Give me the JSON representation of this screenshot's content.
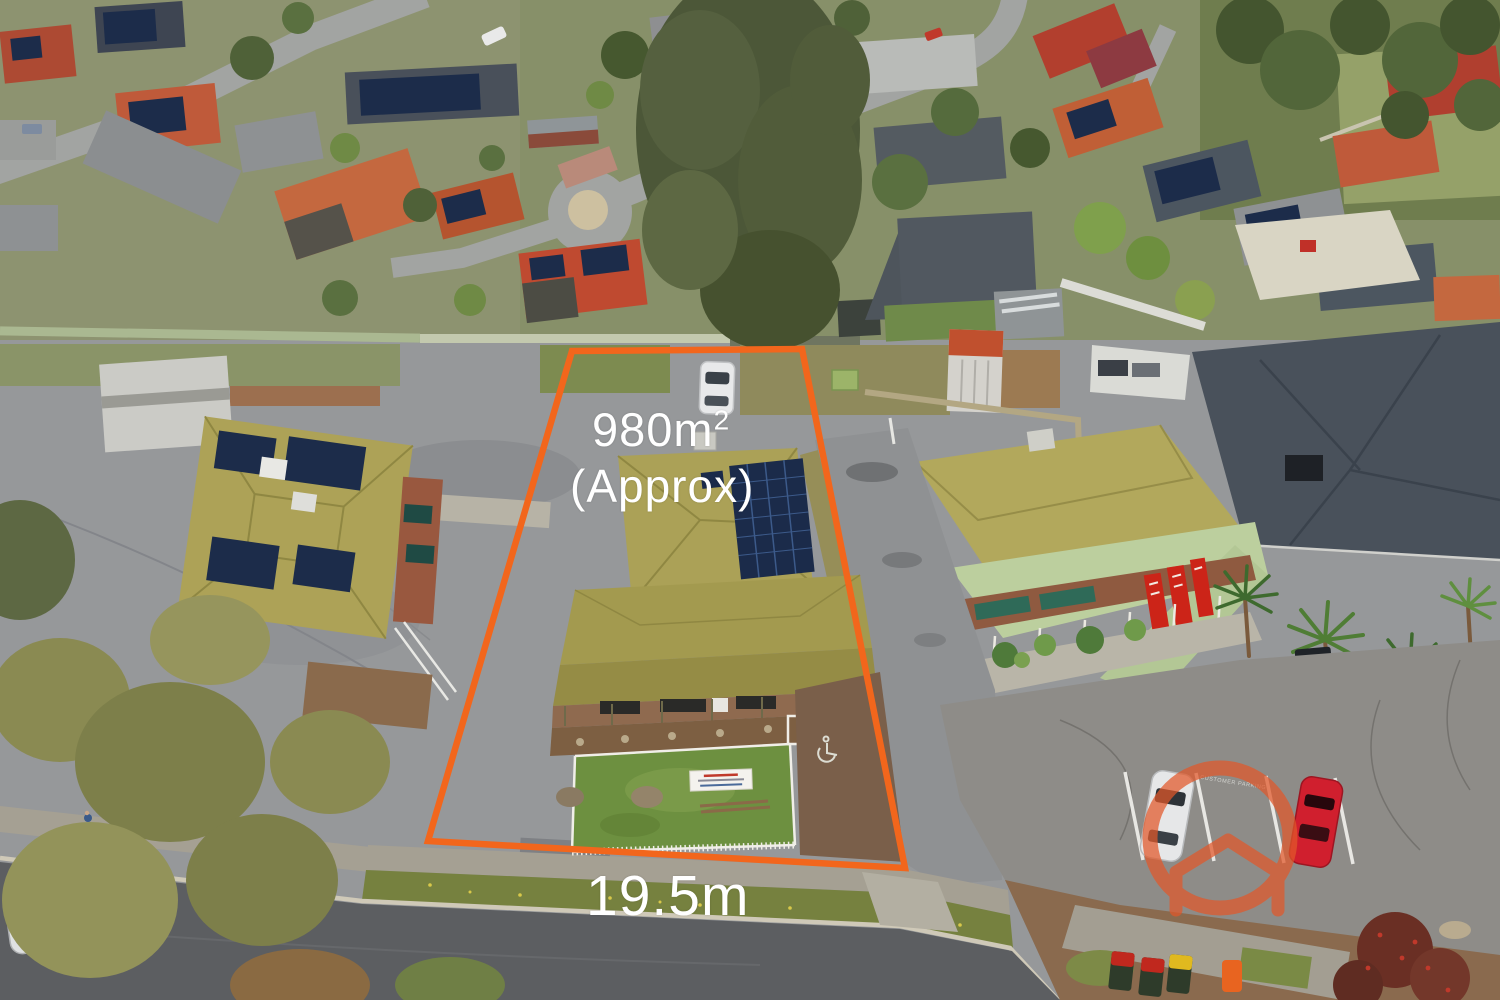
{
  "meta": {
    "type": "aerial-property-photo",
    "subject": "residential allotment with orange boundary overlay"
  },
  "annotations": {
    "area": {
      "value": "980m",
      "superscript": "2",
      "qualifier": "(Approx)"
    },
    "frontage": "19.5m",
    "text_color": "#ffffff",
    "boundary_color": "#f2661c"
  },
  "watermark": {
    "icon": "house-circle-logo",
    "color": "#e2582a"
  },
  "road_markings": {
    "customer_parking": "CUSTOMER PARKING",
    "accessible_parking": "wheelchair-symbol"
  },
  "scene": {
    "palette": {
      "subject_roof": "#aba157",
      "solar_panel": "#1c2c4a",
      "asphalt": "#96989a",
      "road": "#5c5e61",
      "lawn": "#6d9040",
      "shop_roof": "#b2a85c",
      "dark_roof": "#49515b",
      "terracotta_roof": "#c05f36",
      "tree_olive": "#8a8a52",
      "tree_dark": "#4d5f3c"
    }
  }
}
